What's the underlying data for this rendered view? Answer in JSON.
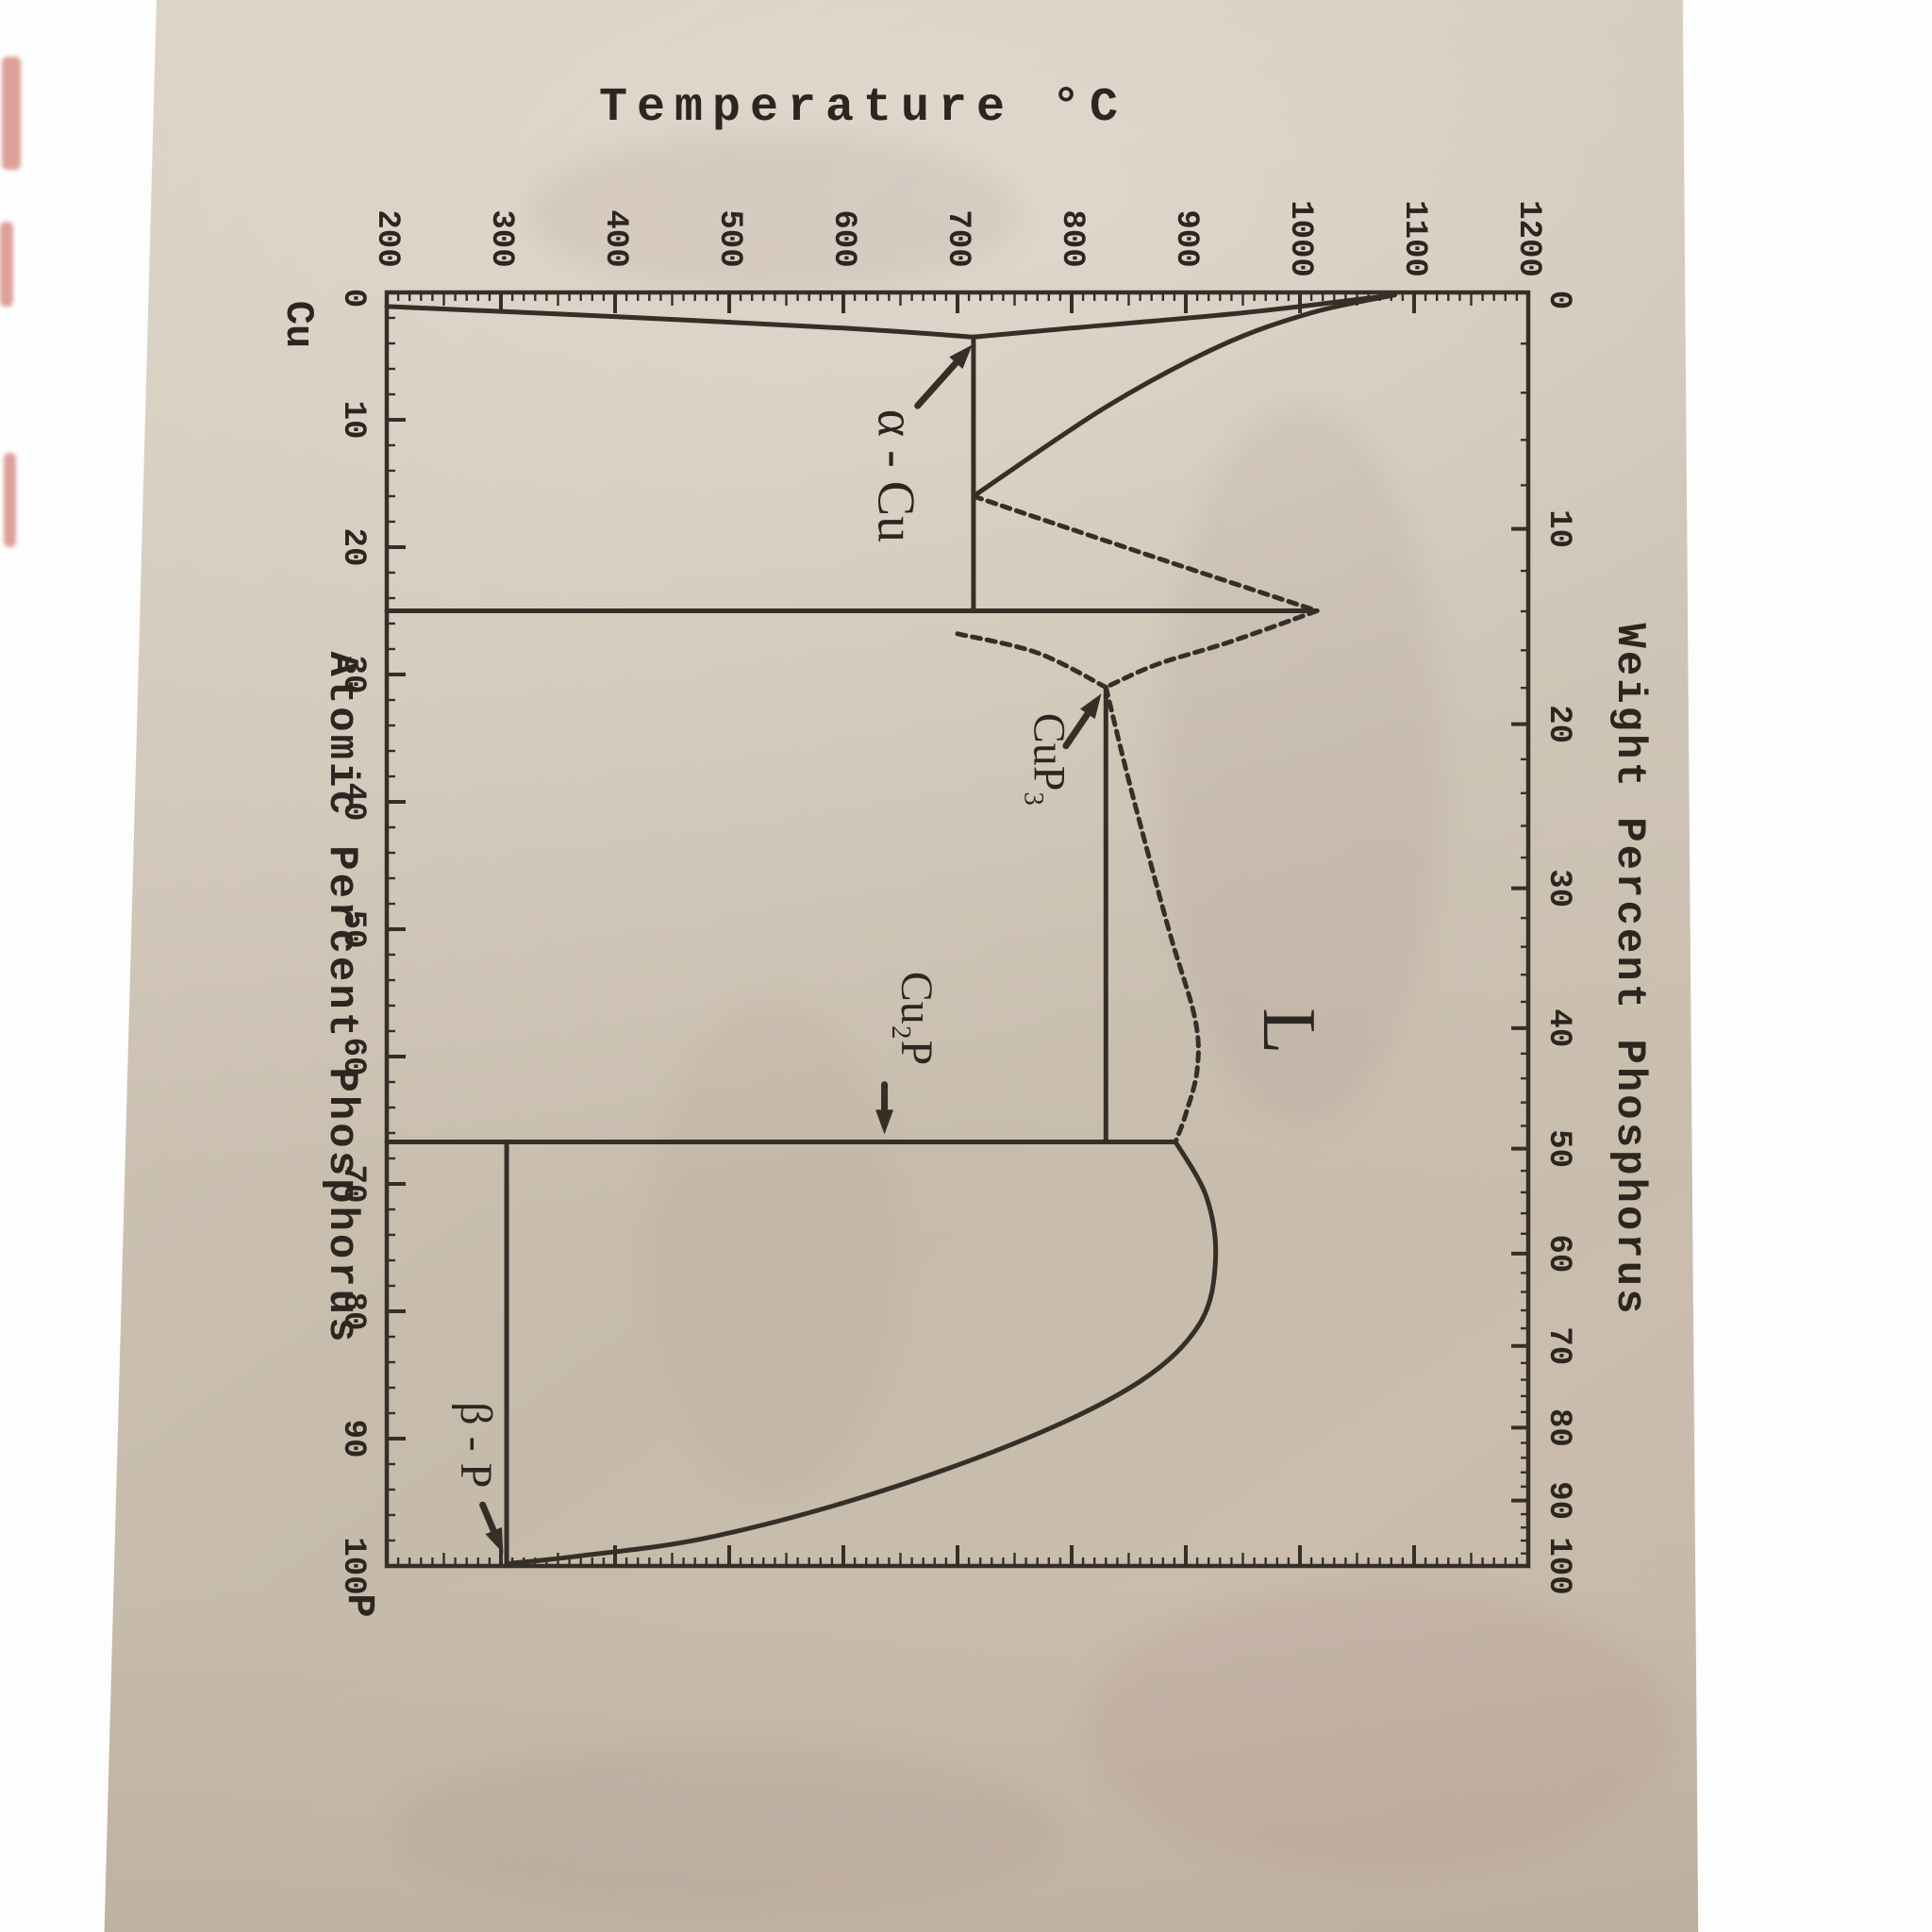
{
  "figure": {
    "kind": "phase-diagram",
    "system": "Cu-P",
    "orientation_note": "book page photographed rotated 90 degrees clockwise"
  },
  "axes": {
    "temperature": {
      "title": "Temperature °C",
      "unit": "°C",
      "min": 200,
      "max": 1200,
      "ticks": [
        200,
        300,
        400,
        500,
        600,
        700,
        800,
        900,
        1000,
        1100,
        1200
      ]
    },
    "atomic_percent": {
      "title": "Atomic Percent Phosphorus",
      "min": 0,
      "max": 100,
      "ticks": [
        0,
        10,
        20,
        30,
        40,
        50,
        60,
        70,
        80,
        90,
        100
      ],
      "end_label_start": "Cu",
      "end_label_end": "P"
    },
    "weight_percent": {
      "title": "Weight Percent Phosphorus",
      "min": 0,
      "max": 100,
      "ticks": [
        0,
        10,
        20,
        30,
        40,
        50,
        60,
        70,
        80,
        90,
        100
      ]
    }
  },
  "chart_data": {
    "type": "line",
    "title": "Temperature °C",
    "xlabel": "Atomic Percent Phosphorus",
    "x2label": "Weight Percent Phosphorus",
    "ylabel_range": [
      200,
      1200
    ],
    "grid": false,
    "key_points": [
      {
        "name": "Cu melting point",
        "at_pct": 0,
        "temp_c": 1083
      },
      {
        "name": "eutectic L -> aCu + CuP3",
        "at_pct": 16,
        "temp_c": 714
      },
      {
        "name": "CuP3 congruent melting",
        "at_pct": 25,
        "temp_c": 1015
      },
      {
        "name": "eutectic L -> CuP3 + Cu2P",
        "at_pct": 31,
        "temp_c": 830
      },
      {
        "name": "Cu2P congruent melting",
        "at_pct": 66.7,
        "temp_c": 891
      },
      {
        "name": "P-side liquidus terminus",
        "at_pct": 100,
        "temp_c": 305
      }
    ],
    "curves": [
      {
        "name": "alpha-solvus",
        "dashed": false,
        "pts": [
          [
            200,
            1.1
          ],
          [
            400,
            1.9
          ],
          [
            600,
            2.8
          ],
          [
            714,
            3.5
          ]
        ]
      },
      {
        "name": "solidus-cu",
        "dashed": false,
        "pts": [
          [
            714,
            3.5
          ],
          [
            800,
            2.8
          ],
          [
            950,
            1.6
          ],
          [
            1083,
            0.2
          ]
        ]
      },
      {
        "name": "liquidus-cu",
        "dashed": false,
        "pts": [
          [
            1083,
            0.2
          ],
          [
            1010,
            1.6
          ],
          [
            930,
            4.2
          ],
          [
            830,
            9.0
          ],
          [
            714,
            16
          ]
        ]
      },
      {
        "name": "eutectic1-isotherm",
        "dashed": false,
        "straight": true,
        "pts": [
          [
            714,
            3.5
          ],
          [
            714,
            25
          ]
        ]
      },
      {
        "name": "liquidus-e1-to-cup3",
        "dashed": true,
        "pts": [
          [
            714,
            16
          ],
          [
            800,
            18.6
          ],
          [
            900,
            21.6
          ],
          [
            1015,
            25
          ]
        ]
      },
      {
        "name": "cup3-compound-line",
        "dashed": false,
        "straight": true,
        "pts": [
          [
            200,
            25
          ],
          [
            1015,
            25
          ]
        ]
      },
      {
        "name": "cup3-lower-edge",
        "dashed": true,
        "pts": [
          [
            700,
            26.8
          ],
          [
            770,
            28.3
          ],
          [
            830,
            31
          ]
        ]
      },
      {
        "name": "liquidus-cup3-to-e2",
        "dashed": true,
        "pts": [
          [
            1015,
            25
          ],
          [
            940,
            27.4
          ],
          [
            875,
            29.2
          ],
          [
            830,
            31
          ]
        ]
      },
      {
        "name": "eutectic2-isotherm",
        "dashed": false,
        "straight": true,
        "pts": [
          [
            830,
            31
          ],
          [
            830,
            66.7
          ]
        ]
      },
      {
        "name": "liquidus-e2-to-cu2p",
        "dashed": true,
        "pts": [
          [
            830,
            31
          ],
          [
            852,
            39
          ],
          [
            885,
            50
          ],
          [
            908,
            57
          ],
          [
            910,
            61
          ],
          [
            900,
            64.5
          ],
          [
            891,
            66.7
          ]
        ]
      },
      {
        "name": "cu2p-compound-line",
        "dashed": false,
        "straight": true,
        "pts": [
          [
            200,
            66.7
          ],
          [
            891,
            66.7
          ]
        ]
      },
      {
        "name": "liquidus-p-side",
        "dashed": false,
        "pts": [
          [
            891,
            66.7
          ],
          [
            918,
            71
          ],
          [
            926,
            76
          ],
          [
            912,
            81
          ],
          [
            860,
            85.5
          ],
          [
            760,
            90
          ],
          [
            620,
            94.5
          ],
          [
            480,
            97.8
          ],
          [
            370,
            99.2
          ],
          [
            308,
            99.8
          ]
        ]
      },
      {
        "name": "p-eutectic-isotherm",
        "dashed": false,
        "straight": true,
        "pts": [
          [
            305,
            66.7
          ],
          [
            305,
            100
          ]
        ]
      }
    ],
    "region_labels": [
      {
        "text": "α - Cu",
        "temp_c": 646,
        "at_pct": 14.4,
        "size": 56
      },
      {
        "text": "CuP₃",
        "temp_c": 780,
        "at_pct": 36.7,
        "size": 48
      },
      {
        "text": "L",
        "temp_c": 990,
        "at_pct": 58.0,
        "size": 80
      },
      {
        "text": "Cu₂P",
        "temp_c": 664,
        "at_pct": 57.0,
        "size": 48
      },
      {
        "text": "β - P",
        "temp_c": 278,
        "at_pct": 90.5,
        "size": 48
      }
    ],
    "arrows": [
      {
        "name": "alpha-cu-arrow",
        "from": [
          665,
          8.9
        ],
        "to": [
          713,
          4.1
        ]
      },
      {
        "name": "cup3-arrow",
        "from": [
          795,
          35.6
        ],
        "to": [
          826,
          31.5
        ]
      },
      {
        "name": "cu2p-arrow",
        "from": [
          636,
          62.2
        ],
        "to": [
          636,
          66.1
        ]
      },
      {
        "name": "beta-p-arrow",
        "from": [
          284,
          95.2
        ],
        "to": [
          302,
          99.0
        ]
      }
    ]
  }
}
